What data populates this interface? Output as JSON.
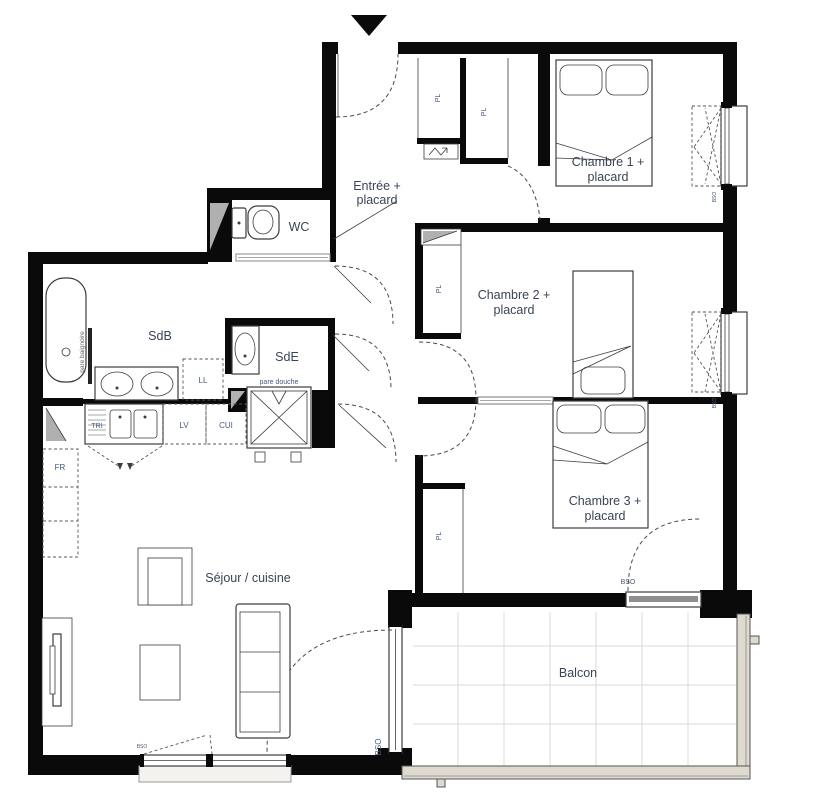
{
  "plan": {
    "rooms": {
      "entree": {
        "line1": "Entrée +",
        "line2": "placard"
      },
      "wc": {
        "label": "WC"
      },
      "sdb": {
        "label": "SdB"
      },
      "sde": {
        "label": "SdE"
      },
      "chambre1": {
        "line1": "Chambre 1 +",
        "line2": "placard"
      },
      "chambre2": {
        "line1": "Chambre 2 +",
        "line2": "placard"
      },
      "chambre3": {
        "line1": "Chambre 3 +",
        "line2": "placard"
      },
      "sejour": {
        "label": "Séjour / cuisine"
      },
      "balcon": {
        "label": "Balcon"
      }
    },
    "annotations": {
      "pl": "PL",
      "ll": "LL",
      "lv": "LV",
      "cui": "CUI",
      "fr": "FR",
      "tri": "TRI",
      "bso": "BSO",
      "pare_douche": "pare douche",
      "pare_baignoire": "pare baignoire"
    },
    "colors": {
      "wall": "#0a0a0a",
      "room_label": "#3a4456",
      "annotation_label": "#47597a",
      "line": "#3c3c3c",
      "grey_fill": "#b0b0b0",
      "balcony_grid": "#d8d8d8",
      "railing_fill": "#dedacf"
    }
  }
}
